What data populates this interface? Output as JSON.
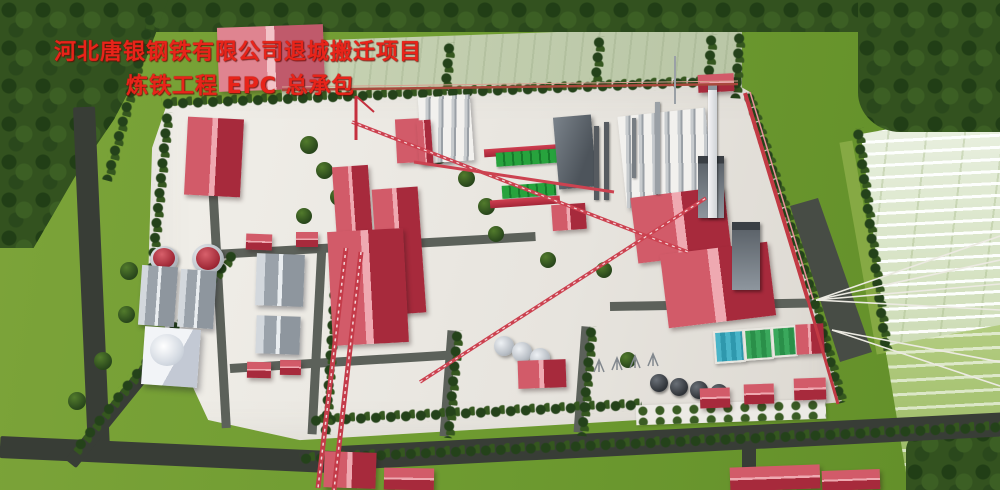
{
  "overlay": {
    "line1": "河北唐银钢铁有限公司退城搬迁项目",
    "line2": "炼铁工程 EPC 总承包"
  },
  "palette": {
    "title_red": "#e8241a",
    "grass": "#6f9c31",
    "tree_dark": "#2c4a1c",
    "pavement": "#edeae5",
    "road_dark": "#383d36",
    "road_inner": "#5c615a",
    "roof_red": "#c23a4c",
    "roof_ridge": "#efa9b1",
    "roof_gray": "#9aa2aa",
    "ghost_yard": "#d7e3c4",
    "pool_teal": "#35a8bd",
    "pool_green": "#2f9e50",
    "conveyor_red": "#c43b49",
    "chimney_white": "#e9e9eb",
    "steel_gray": "#7d848b"
  }
}
